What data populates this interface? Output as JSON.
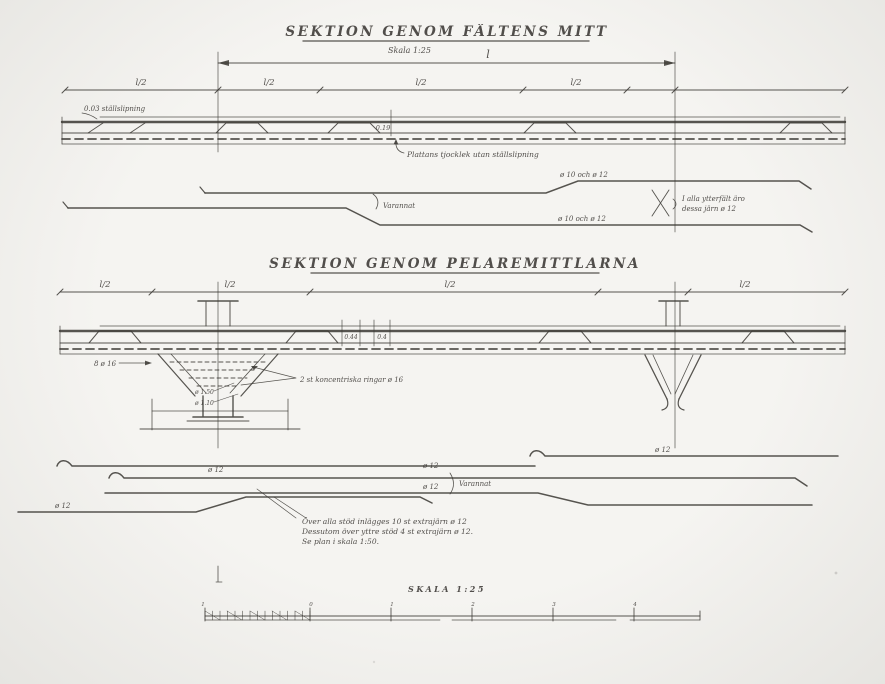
{
  "colors": {
    "ink": "#3a3733",
    "paper_light": "#f5f4f1",
    "paper_dark": "#e6e5e1"
  },
  "section1": {
    "title": "SEKTION GENOM FÄLTENS MITT",
    "scale_note": "Skala 1:25",
    "span_dim_label": "l",
    "dim_segments": [
      "l/2",
      "l/2",
      "l/2",
      "l/2"
    ],
    "surface_label": "0.03 ställslipning",
    "thickness_dim": "0.19",
    "thickness_label": "Plattans tjocklek utan ställslipning",
    "rebar_top_label": "ø 10 och ø 12",
    "rebar_bottom_label": "ø 10 och ø 12",
    "alternate_label": "Varannat",
    "outer_span_note_line1": "I alla ytterfält äro",
    "outer_span_note_line2": "dessa järn ø 12"
  },
  "section2": {
    "title": "SEKTION GENOM PELAREMITTLARNA",
    "dim_segments": [
      "l/2",
      "l/2",
      "l/2",
      "l/2"
    ],
    "slab_dim_left": "0.44",
    "slab_dim_right": "0.4",
    "column_bars_label": "8 ø 16",
    "rings_label": "2 st koncentriska ringar ø 16",
    "column_dia_upper": "ø 1.50",
    "column_dia_lower": "ø 1.10",
    "rebar_label_right": "ø 12",
    "rebar_label_left": "ø 12",
    "rebar_label_mid_top": "ø 12",
    "rebar_label_mid_bottom": "ø 12",
    "rebar_label_far_left": "ø 12",
    "alternate_label": "Varannat",
    "note_line1": "Över alla stöd inlägges 10 st extrajärn ø 12",
    "note_line2": "Dessutom över yttre stöd 4 st extrajärn ø 12.",
    "note_line3": "Se plan i skala 1:50."
  },
  "scale_bar": {
    "label": "SKALA 1:25",
    "ruler_labels": [
      "1",
      "0",
      "1",
      "2",
      "3",
      "4"
    ]
  }
}
